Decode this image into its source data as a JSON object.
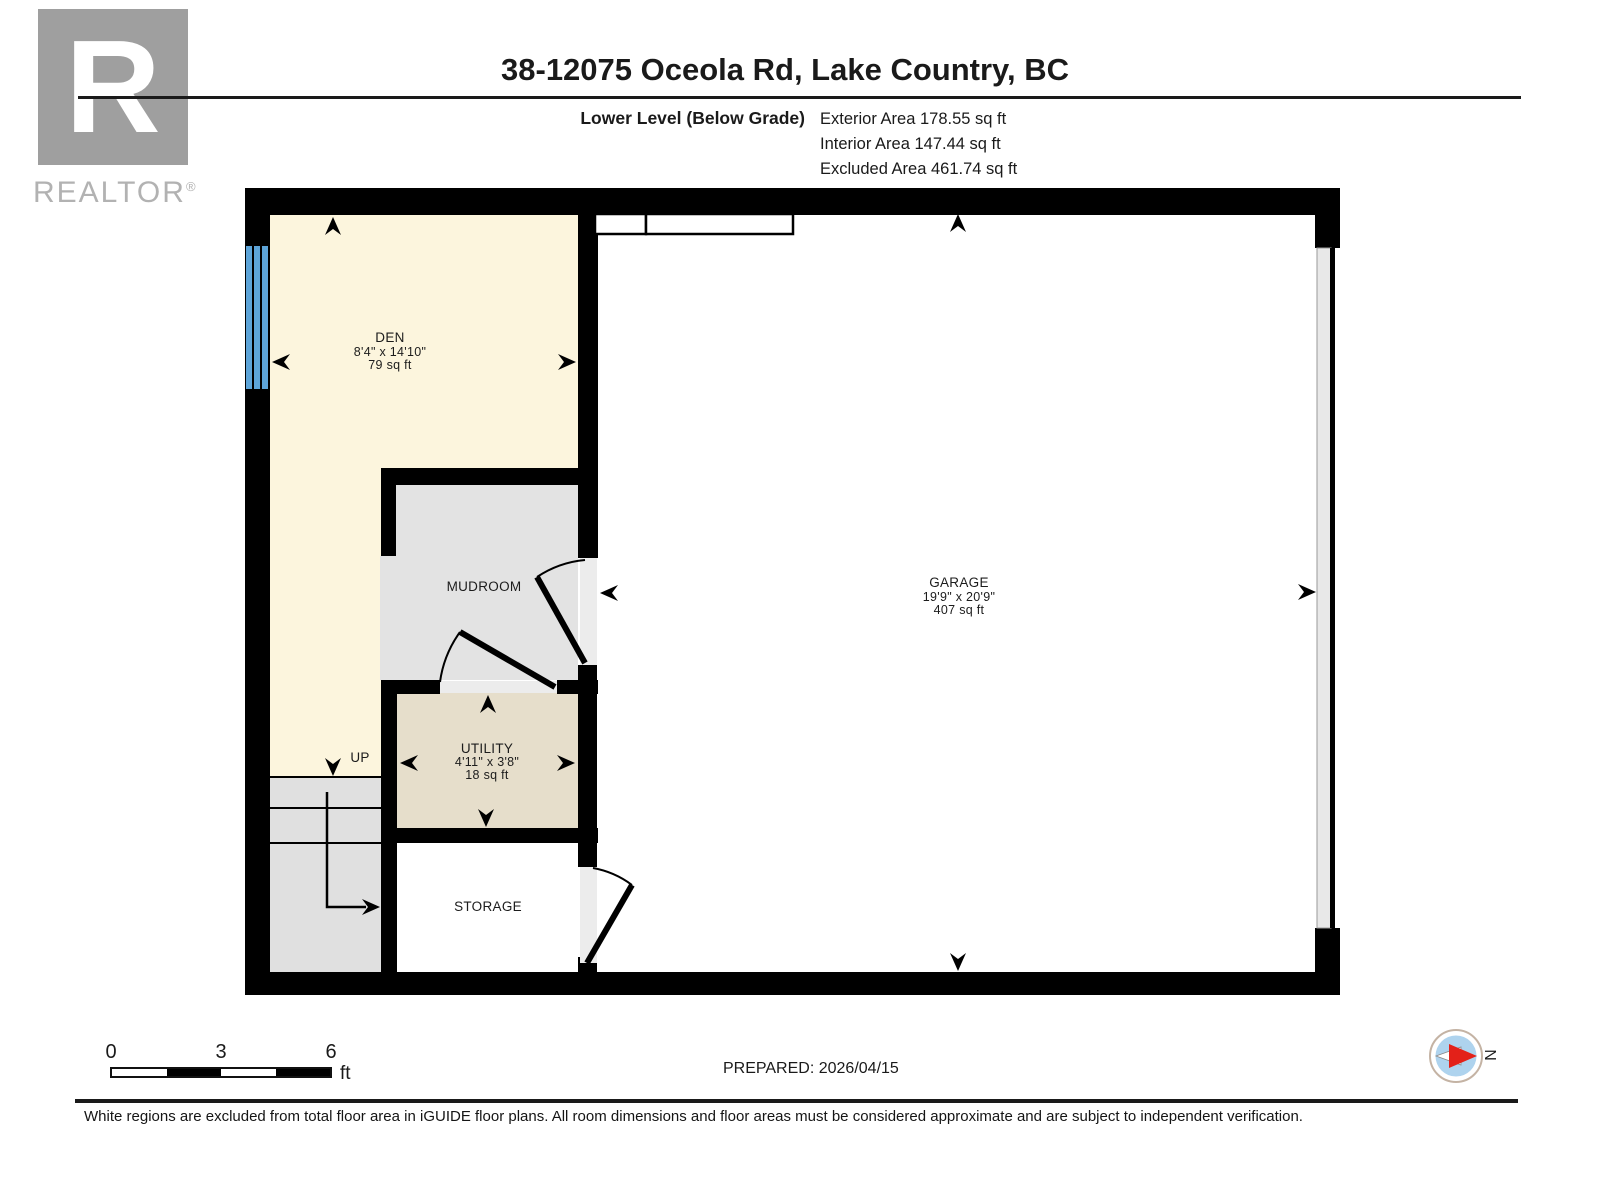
{
  "header": {
    "logo": {
      "letter": "R",
      "brand": "REALTOR",
      "registered": "®"
    },
    "title": "38-12075 Oceola Rd, Lake Country, BC",
    "level_label": "Lower Level (Below Grade)",
    "areas": [
      {
        "label": "Exterior Area",
        "value": "178.55 sq ft"
      },
      {
        "label": "Interior Area",
        "value": "147.44 sq ft"
      },
      {
        "label": "Excluded Area",
        "value": "461.74 sq ft"
      }
    ]
  },
  "floorplan": {
    "rooms": [
      {
        "name": "DEN",
        "dims": "8'4\" x 14'10\"",
        "area": "79 sq ft"
      },
      {
        "name": "MUDROOM"
      },
      {
        "name": "UTILITY",
        "dims": "4'11\" x 3'8\"",
        "area": "18 sq ft"
      },
      {
        "name": "STORAGE"
      },
      {
        "name": "GARAGE",
        "dims": "19'9\" x 20'9\"",
        "area": "407 sq ft"
      }
    ],
    "stairs_label": "UP",
    "colors": {
      "den": "#fcf5dd",
      "mudroom": "#e3e3e3",
      "utility": "#e6decb",
      "storage": "#ffffff",
      "garage": "#ffffff",
      "stairs": "#e0e0e0",
      "wall": "#000000",
      "window": "#5da4d8",
      "door_gap": "#ececec",
      "garage_door": "#e8e8e8"
    }
  },
  "footer": {
    "scale_bar": {
      "ticks": [
        "0",
        "3",
        "6"
      ],
      "unit": "ft"
    },
    "prepared": "PREPARED: 2026/04/15",
    "compass": {
      "north_label": "N",
      "needle_color": "#e32119",
      "face_color": "#aed3ee",
      "ring_color": "#c4b3a4"
    },
    "disclaimer": "White regions are excluded from total floor area in iGUIDE floor plans. All room dimensions and floor areas must be considered approximate and are subject to independent verification."
  }
}
